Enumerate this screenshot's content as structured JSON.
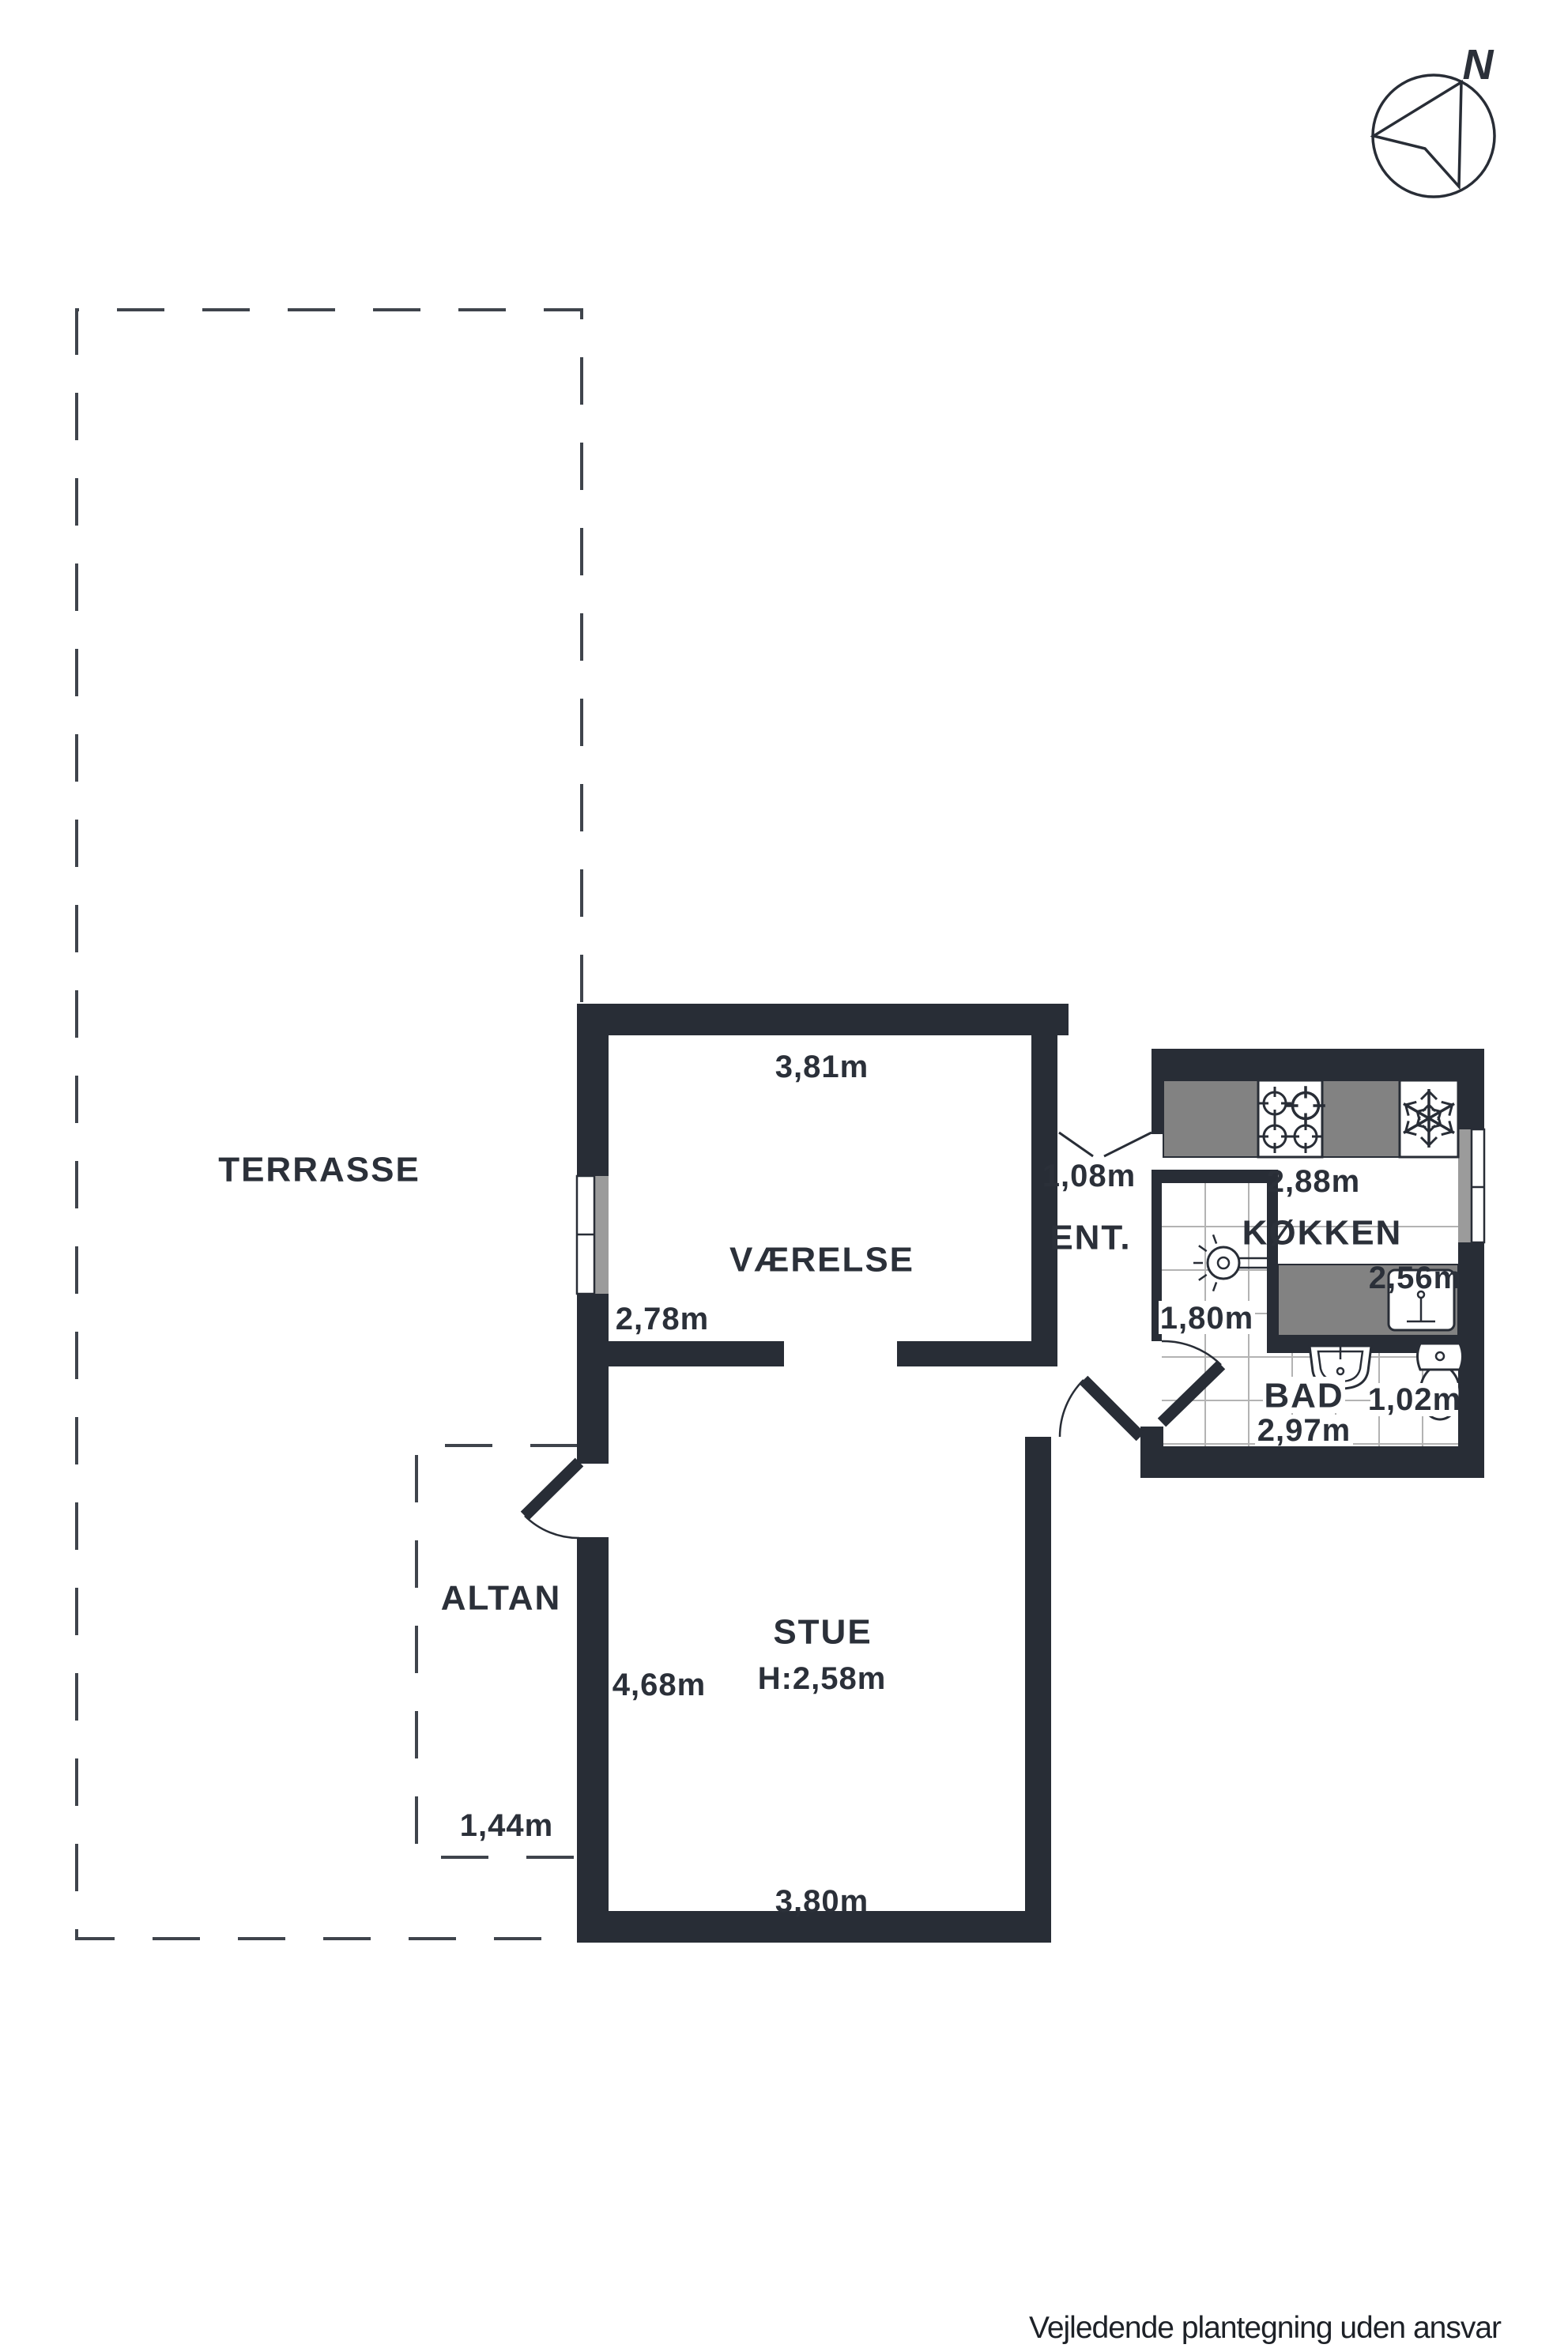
{
  "compass": {
    "label": "N"
  },
  "rooms": {
    "terrasse": {
      "name": "TERRASSE"
    },
    "vaerelse": {
      "name": "VÆRELSE",
      "width_label": "3,81m",
      "depth_label": "2,78m"
    },
    "ent": {
      "name": "ENT.",
      "width_label": "1,08m"
    },
    "koekken": {
      "name": "KØKKEN",
      "width_label": "2,88m",
      "depth_label": "2,56m"
    },
    "shower": {
      "depth_label": "1,80m"
    },
    "bad": {
      "name": "BAD",
      "width_label": "2,97m",
      "depth_label": "1,02m"
    },
    "stue": {
      "name": "STUE",
      "ceiling_label": "H:2,58m",
      "depth_label": "4,68m",
      "width_label": "3,80m"
    },
    "altan": {
      "name": "ALTAN",
      "width_label": "1,44m"
    }
  },
  "footer": {
    "note": "Vejledende plantegning uden ansvar"
  },
  "colors": {
    "wall": "#282d36",
    "counter": "#828282",
    "glazing": "#9b9b9b",
    "tile": "#b3b3b3",
    "dash": "#3f444c",
    "text": "#2b3039"
  }
}
